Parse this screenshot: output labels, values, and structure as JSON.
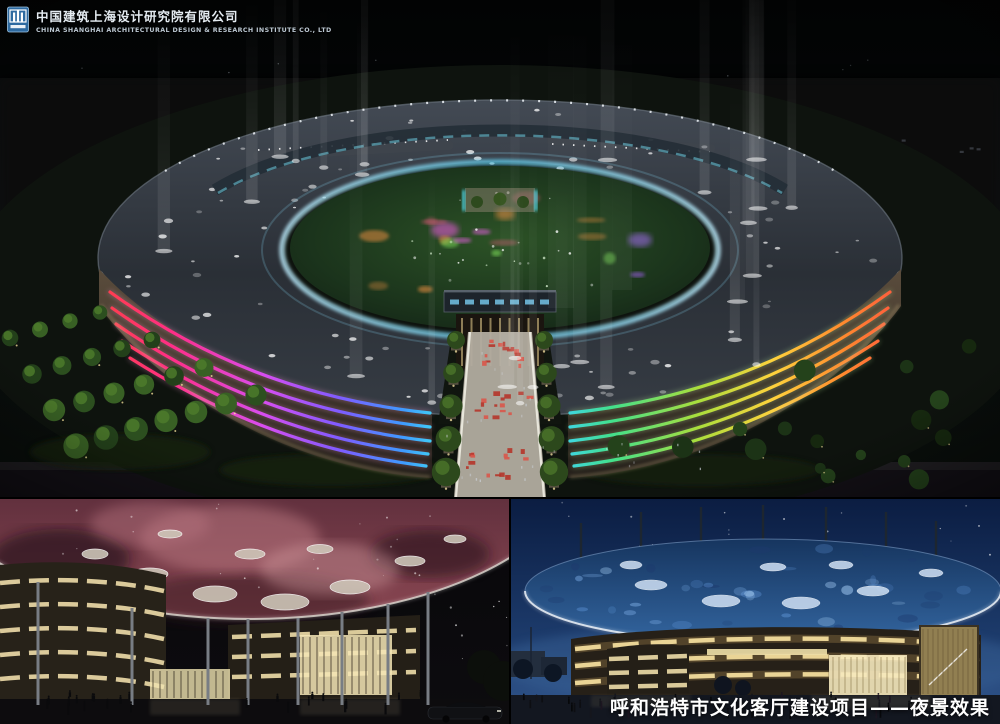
{
  "header": {
    "logo_icon": "cscec-emblem-icon",
    "company_name_zh": "中国建筑上海设计研究院有限公司",
    "company_name_en": "CHINA SHANGHAI ARCHITECTURAL DESIGN & RESEARCH INSTITUTE CO., LTD"
  },
  "caption": {
    "text": "呼和浩特市文化客厅建设项目——夜景效果"
  },
  "colors": {
    "background": "#000000",
    "beam_light": "#ffffff",
    "facade_left_stripes": [
      "#ff4044",
      "#ff2e86",
      "#d84df0",
      "#7e5cff",
      "#41e0f0"
    ],
    "facade_right_stripes": [
      "#3fd4f0",
      "#42e08c",
      "#aade3c",
      "#ffd23c",
      "#ff8a2e",
      "#ff5340"
    ],
    "red_carpet": "#c0392b",
    "nebula_ceiling": "#8a4752",
    "disc_roof_blue": "#33659f",
    "warm_band_light": "#f2dc9c",
    "night_sky_blue": "#0b1d42"
  }
}
